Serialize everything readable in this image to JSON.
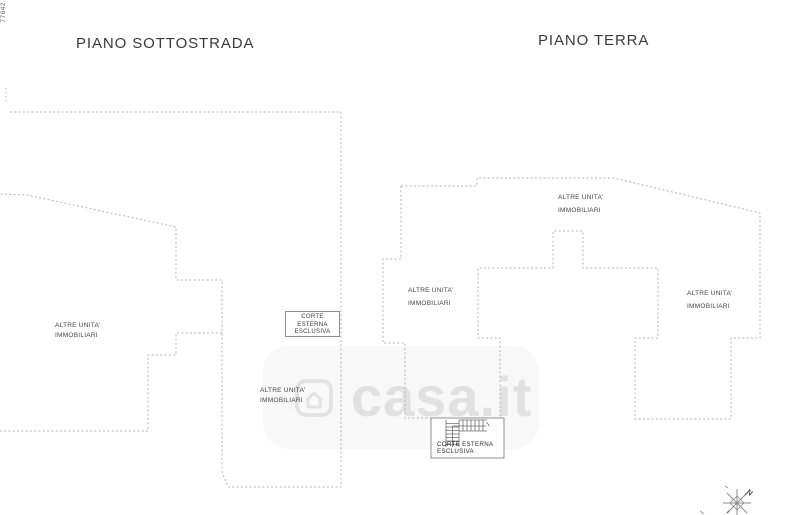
{
  "document": {
    "sheet_code": "77642",
    "floor_titles": {
      "sottostrada": "PIANO SOTTOSTRADA",
      "terra": "PIANO TERRA"
    },
    "unit_label": {
      "line1": "ALTRE UNITA'",
      "line2": "IMMOBILIARI"
    },
    "corte_box_left": {
      "line1": "CORTE",
      "line2": "ESTERNA",
      "line3": "ESCLUSIVA"
    },
    "corte_box_bottom": {
      "line1": "CORTE ESTERNA",
      "line2": "ESCLUSIVA"
    },
    "watermark": {
      "brand": "casa.it"
    },
    "compass": {
      "north": "N"
    },
    "colors": {
      "dashed_line": "#b5b5b5",
      "solid_line": "#8f8f8f",
      "title_text": "#3a3a3a",
      "label_text": "#454545",
      "background": "#ffffff"
    }
  }
}
